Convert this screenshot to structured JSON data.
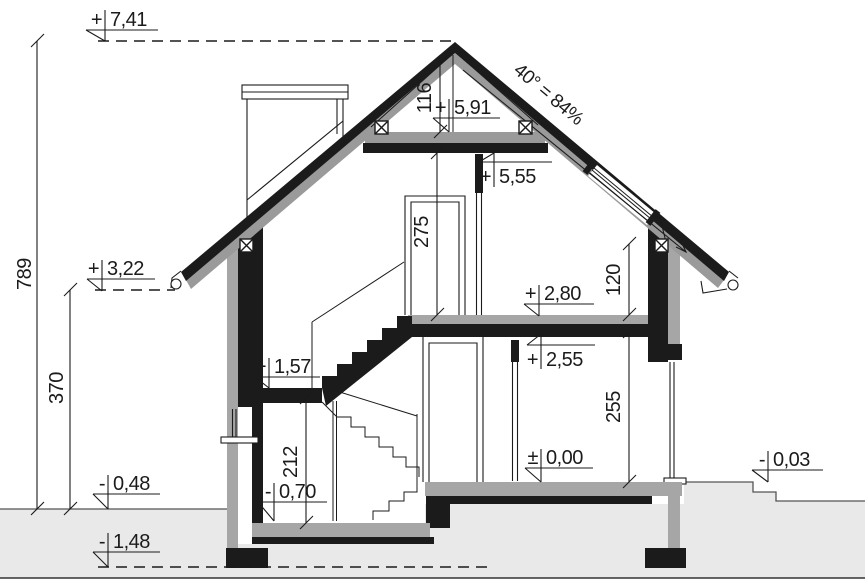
{
  "drawing_title": "house-cross-section",
  "levels": {
    "ridge": {
      "sign": "+",
      "value": "7,41"
    },
    "collar_top": {
      "sign": "+",
      "value": "5,91"
    },
    "attic_ceiling": {
      "sign": "+",
      "value": "5,55"
    },
    "eaves_left": {
      "sign": "+",
      "value": "3,22"
    },
    "attic_floor": {
      "sign": "+",
      "value": "2,80"
    },
    "ground_ceiling": {
      "sign": "+",
      "value": "2,55"
    },
    "stair_landing": {
      "sign": "+",
      "value": "1,57"
    },
    "ground_floor": {
      "sign": "±",
      "value": "0,00"
    },
    "terrain_right": {
      "sign": "-",
      "value": "0,03"
    },
    "terrain_left": {
      "sign": "-",
      "value": "0,48"
    },
    "lower_floor": {
      "sign": "-",
      "value": "0,70"
    },
    "foundation_bottom": {
      "sign": "-",
      "value": "1,48"
    }
  },
  "dimensions": {
    "total_height_cm": "789",
    "eaves_to_ground_cm": "370",
    "ridge_zone_cm": "116",
    "attic_room_height_cm": "275",
    "knee_wall_cm": "120",
    "ground_room_height_cm": "255",
    "lower_room_height_cm": "212"
  },
  "roof": {
    "angle_label": "40° = 84%"
  },
  "colors": {
    "line": "#1b1b1b",
    "wall_gray": "#a6a6a6",
    "roof_gray": "#9a9a9a",
    "terrain": "#e9e9e9"
  }
}
